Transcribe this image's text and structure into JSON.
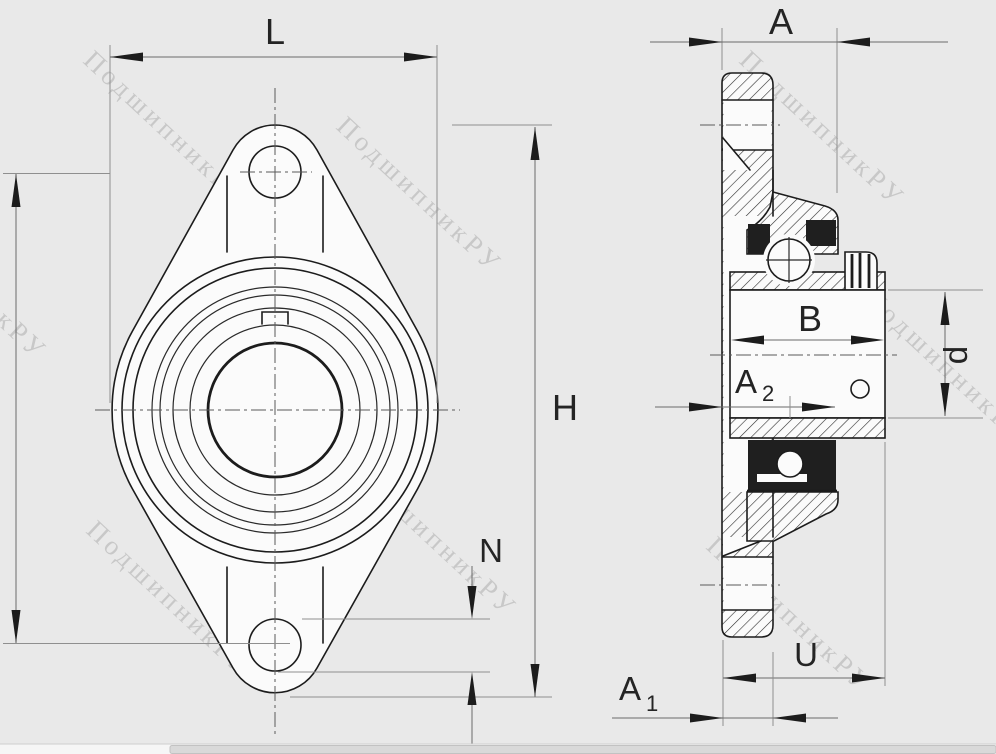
{
  "watermark": {
    "text": "ПодшипникРУ"
  },
  "dims": {
    "L": {
      "label": "L"
    },
    "A": {
      "label": "A"
    },
    "H": {
      "label": "H"
    },
    "N": {
      "label": "N"
    },
    "B": {
      "label": "B"
    },
    "d": {
      "label": "d"
    },
    "U": {
      "label": "U"
    },
    "A2": {
      "base": "A",
      "sub": "2"
    },
    "A1": {
      "base": "A",
      "sub": "1"
    }
  },
  "colors": {
    "background": "#e9e9e9",
    "part_line": "#1c1c1c",
    "dimension_line": "#6a6a6a",
    "extension_line": "#8f8f8f",
    "watermark": "#b3b3b3",
    "part_fill": "#fbfbfb",
    "seal_dark": "#1f1f1f",
    "scrollbar_thumb": "#d9d9d9"
  }
}
